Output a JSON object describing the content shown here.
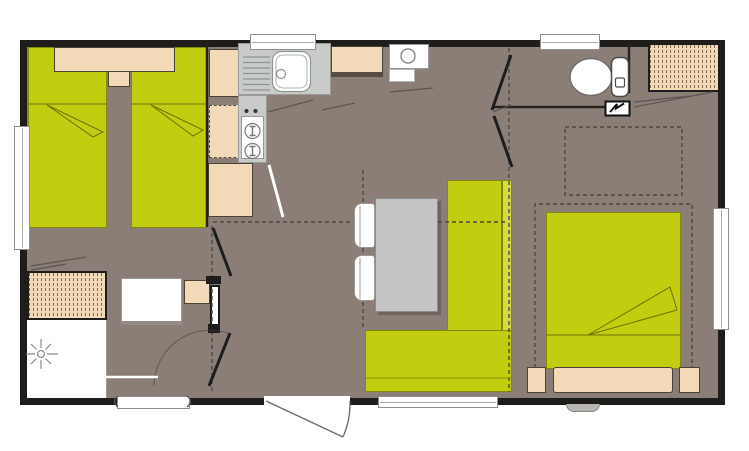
{
  "meta": {
    "type": "floor-plan",
    "description": "Top-down architectural floor plan of a mobile home with two bedrooms, kitchen, living-dining area, shower room and WC. No text labels are rendered in the drawing."
  },
  "colors": {
    "wall": "#1f1d1b",
    "floor": "#8a7e77",
    "bed_green": "#c3cd10",
    "bench_light": "#d6db44",
    "olive": "#7e8a08",
    "beige": "#f2dab8",
    "counter": "#c9cbc8",
    "table": "#c5c5c5",
    "fixture": "#ffffff",
    "step": "#b9b5b1",
    "dash_line": "#4d4843",
    "door_line": "#1d1d1d"
  },
  "rooms": [
    {
      "id": "bedroom-twin",
      "label": "twin bedroom with two single beds"
    },
    {
      "id": "kitchen",
      "label": "kitchen with sink, hob, fridge and cabinets"
    },
    {
      "id": "living-dining",
      "label": "living and dining area with table and corner bench"
    },
    {
      "id": "washroom",
      "label": "shower room with shower, washbasin and wardrobe"
    },
    {
      "id": "wc",
      "label": "separate WC"
    },
    {
      "id": "bedroom-double",
      "label": "double bedroom with wardrobe and overhead lockers"
    }
  ],
  "furniture": [
    {
      "id": "twin-bed-1",
      "label": "single bed"
    },
    {
      "id": "twin-bed-2",
      "label": "single bed"
    },
    {
      "id": "headboard-shelf",
      "label": "headboard shelf with pillows"
    },
    {
      "id": "kitchen-sink",
      "label": "sink with drainer"
    },
    {
      "id": "hob",
      "label": "two-burner hob"
    },
    {
      "id": "fridge",
      "label": "fridge / cupboard"
    },
    {
      "id": "water-heater",
      "label": "water heater"
    },
    {
      "id": "kitchen-cabinets",
      "label": "kitchen cabinet column"
    },
    {
      "id": "dining-table",
      "label": "dining table"
    },
    {
      "id": "chairs",
      "label": "two chairs"
    },
    {
      "id": "corner-bench",
      "label": "L-shaped bench seat"
    },
    {
      "id": "double-bed",
      "label": "double bed with pillow"
    },
    {
      "id": "bedside-tables",
      "label": "bedside tables"
    },
    {
      "id": "overhead-locker",
      "label": "overhead locker (dashed)"
    },
    {
      "id": "wardrobe-left",
      "label": "hanging wardrobe"
    },
    {
      "id": "wardrobe-right",
      "label": "hanging wardrobe"
    },
    {
      "id": "toilet",
      "label": "toilet with cistern"
    },
    {
      "id": "washbasin",
      "label": "washbasin with cabinet"
    },
    {
      "id": "shower",
      "label": "shower tray"
    },
    {
      "id": "radiator",
      "label": "heater / radiator"
    },
    {
      "id": "fuse-box",
      "label": "electrical panel (lightning symbol)"
    }
  ],
  "openings": [
    {
      "id": "window-top-kitchen",
      "type": "window"
    },
    {
      "id": "window-top-wc",
      "type": "window"
    },
    {
      "id": "window-left",
      "type": "window"
    },
    {
      "id": "window-right",
      "type": "window"
    },
    {
      "id": "window-bench",
      "type": "window"
    },
    {
      "id": "window-louvre",
      "type": "louvre window"
    },
    {
      "id": "entry-door",
      "type": "hinged entrance door with swing arc"
    },
    {
      "id": "bedroom-door-left",
      "type": "interior door"
    },
    {
      "id": "washroom-door",
      "type": "interior door"
    },
    {
      "id": "bifold-door-right",
      "type": "bi-fold bedroom door"
    },
    {
      "id": "outside-step",
      "type": "step"
    }
  ]
}
